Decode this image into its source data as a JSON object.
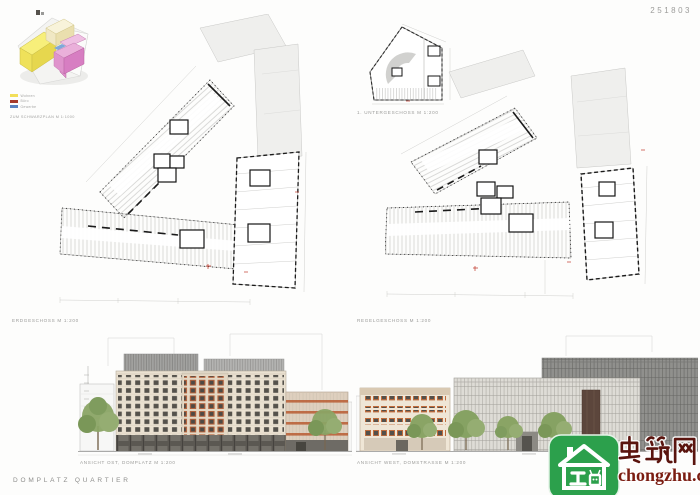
{
  "header": {
    "entry_number": "251803"
  },
  "footer": {
    "project_title": "DOMPLATZ QUARTIER"
  },
  "massing_diagram": {
    "caption": "ZUM SCHWARZPLAN M 1:1000",
    "legend": [
      {
        "label": "Wohnen",
        "color": "#f2df5a"
      },
      {
        "label": "Büro",
        "color": "#a63a2c"
      },
      {
        "label": "Gewerbe",
        "color": "#5b82c0"
      }
    ]
  },
  "plans": {
    "ground": {
      "caption": "ERDGESCHOSS M 1:200"
    },
    "basement": {
      "caption": "1. UNTERGESCHOSS M 1:200"
    },
    "upper": {
      "caption": "REGELGESCHOSS M 1:200"
    }
  },
  "elevations": {
    "east": {
      "caption": "ANSICHT OST, DOMPLATZ M 1:200"
    },
    "west": {
      "caption": "ANSICHT WEST, DOMSTRASSE M 1:200"
    }
  },
  "watermark": {
    "site_name": "虫筑网",
    "site_url": "chongzhu.cn",
    "brand_green": "#2ca04c",
    "brand_red": "#6b1710"
  },
  "colors": {
    "paper": "#fdfdfc",
    "facade_cream": "#eae1d1",
    "accent_terracotta": "#b85c32",
    "elevation_gray": "#90908d",
    "tree_green": "#8aa465",
    "drawing_line": "#c7c7c5",
    "wall_black": "#141414",
    "marker_red": "#c0392b"
  }
}
